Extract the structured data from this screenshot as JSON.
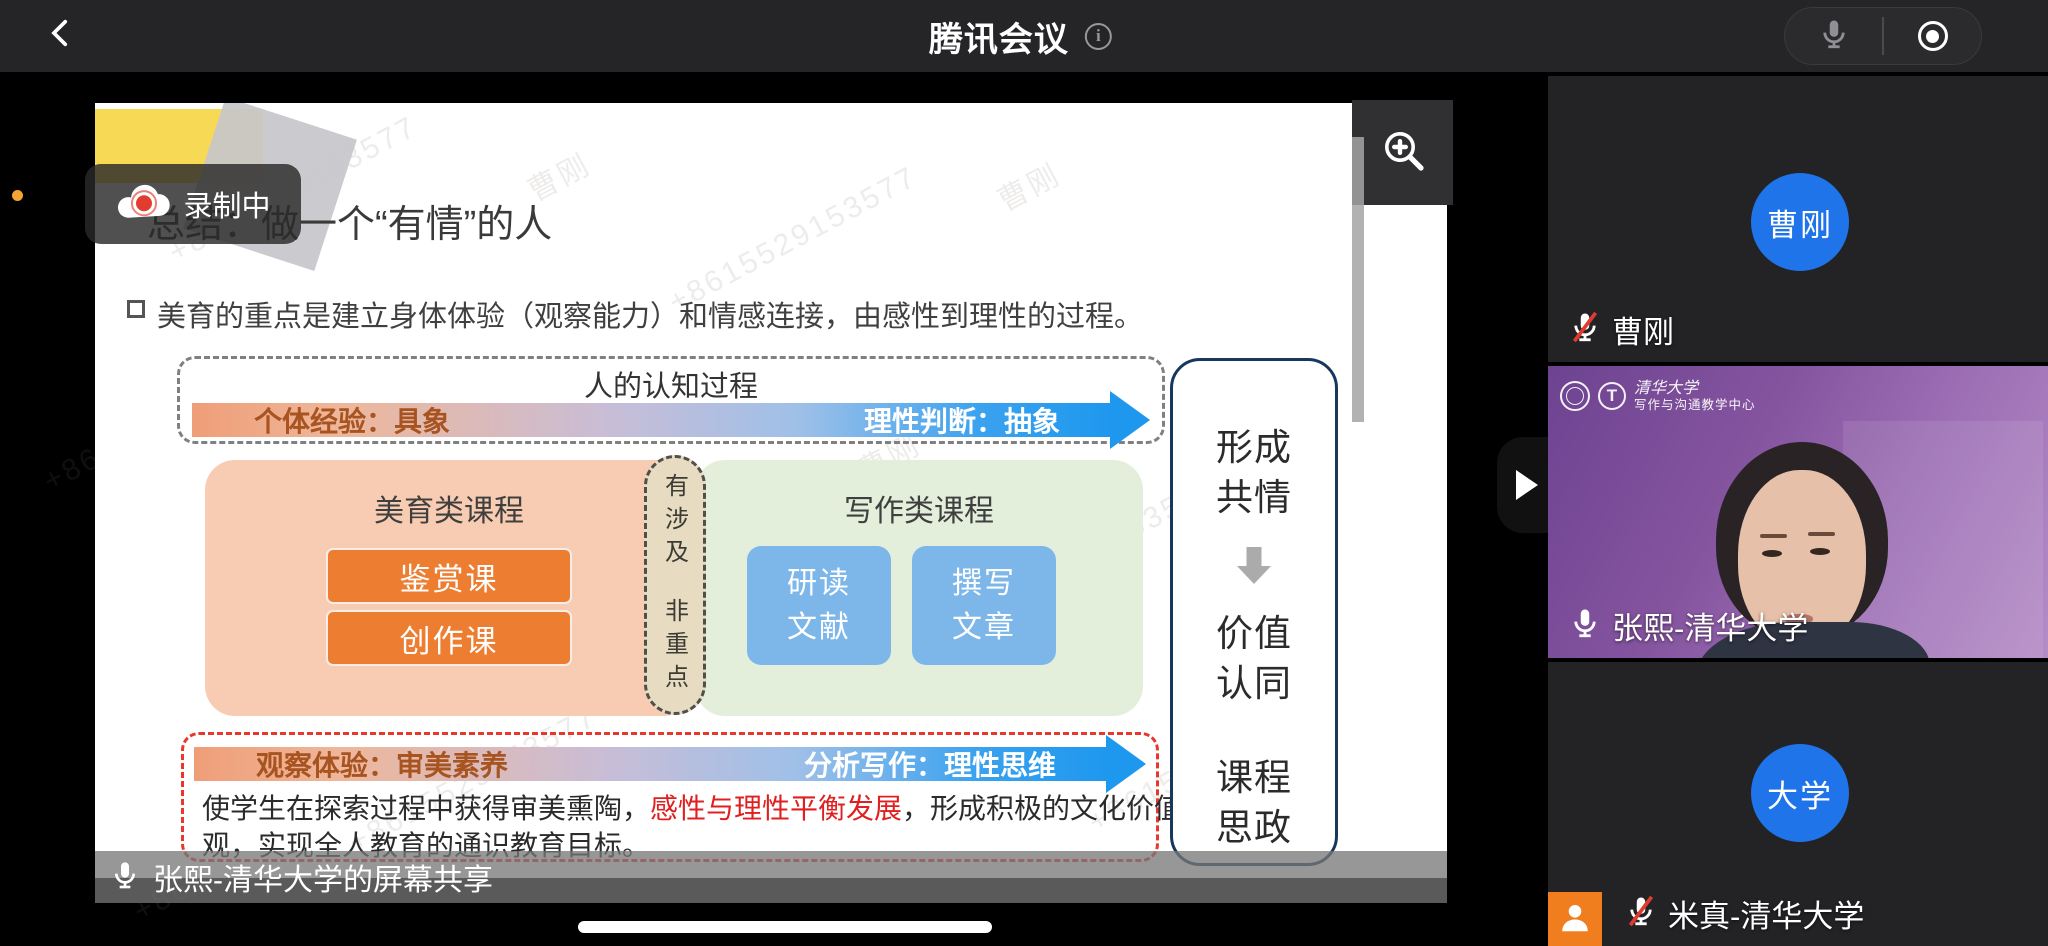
{
  "top_bar": {
    "title": "腾讯会议"
  },
  "recording": {
    "label": "录制中"
  },
  "slide": {
    "title": "总结：做一个“有情”的人",
    "bullet": "美育的重点是建立身体体验（观察能力）和情感连接，由感性到理性的过程。",
    "cognition": {
      "heading": "人的认知过程",
      "left_label": "个体经验：具象",
      "right_label": "理性判断：抽象"
    },
    "aesthetic_panel": {
      "heading": "美育类课程",
      "buttons": [
        "鉴赏课",
        "创作课"
      ]
    },
    "capsule": {
      "top": "有涉及",
      "bottom": "非重点"
    },
    "writing_panel": {
      "heading": "写作类课程",
      "boxes": [
        "研读\n文献",
        "撰写\n文章"
      ]
    },
    "bottom_arrow": {
      "left_label": "观察体验：审美素养",
      "right_label": "分析写作：理性思维"
    },
    "summary": {
      "pre": "使学生在探索过程中获得审美熏陶，",
      "em": "感性与理性平衡发展",
      "post": "，形成积极的文化价值观，实现全人教育的通识教育目标。"
    },
    "outcome": {
      "items": [
        "形成\n共情",
        "价值\n认同",
        "课程\n思政"
      ]
    }
  },
  "watermark": {
    "phone": "+8615529153577",
    "name": "曹刚"
  },
  "share_bar": {
    "label": "张熙-清华大学的屏幕共享"
  },
  "participants": [
    {
      "name": "曹刚",
      "avatar": "曹刚"
    },
    {
      "name": "张熙-清华大学",
      "org": "清华大学",
      "dept": "写作与沟通教学中心"
    },
    {
      "name": "米真-清华大学",
      "avatar": "大学"
    }
  ],
  "colors": {
    "avatar_blue": "#1f74ea",
    "orange": "#ed7d31",
    "panel_peach": "#f8ccb2",
    "panel_green": "#e4efdb",
    "box_blue": "#7db7e9",
    "arrow_blue": "#1e98ee",
    "dashed_red": "#e8372c",
    "navy": "#17375e",
    "record_red": "#e23c2e",
    "slide_yellow": "#f8d955"
  }
}
